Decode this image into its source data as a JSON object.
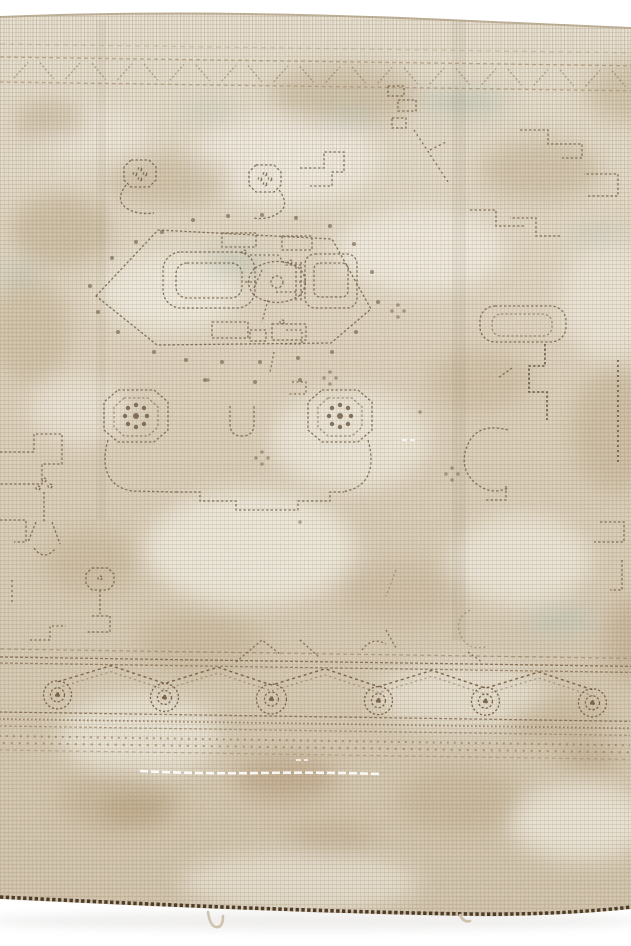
{
  "scene": {
    "type": "product-photograph",
    "subject": "Distressed vintage hand-knotted oriental area rug photographed at a slight perspective angle on a seamless white studio background",
    "style": "Faded antique Oushak style: open beige field, stepped hexagon center medallion, curled hook motifs with octagonal rosette heads, stepped zigzag spandrels, rosette-and-diagonal garland main border",
    "condition": "Pile worn to foundation, mottled abrash, tan staining, white exposed weft streak, dark whip-stitched end finish",
    "background_color": "#ffffff"
  },
  "rug": {
    "colors": {
      "field_light": "#e9e2d2",
      "field_mid": "#dbceb8",
      "field_dark": "#cfc1a8",
      "wear_light": "#f3efe4",
      "wear_tan": "#c0ad8e",
      "stain_brown": "#b09672",
      "tint_teal": "#bcc7b9",
      "outline": "#6e5b44",
      "outline_dark": "#54412e",
      "border_accent": "#7c6549",
      "hem_dark": "#4e3c2a",
      "selvage_beige": "#cfc2ac",
      "edge_line": "#b3a288"
    },
    "parts": {
      "top_border": "faded minor border band near far edge",
      "field": "open mottled beige field",
      "medallion": "central elongated hexagon medallion with geometric interior",
      "hooks": "curled hook motifs with octagonal rosette heads above and below medallion",
      "spandrels": "stepped zigzag corner and side motifs",
      "main_border": "rosette and diagonal garland border across lower edge",
      "guard_border": "dotted guard stripes below main border",
      "hem": "dark stitched hem with short plain-weave end and tiny tassel loop"
    }
  }
}
